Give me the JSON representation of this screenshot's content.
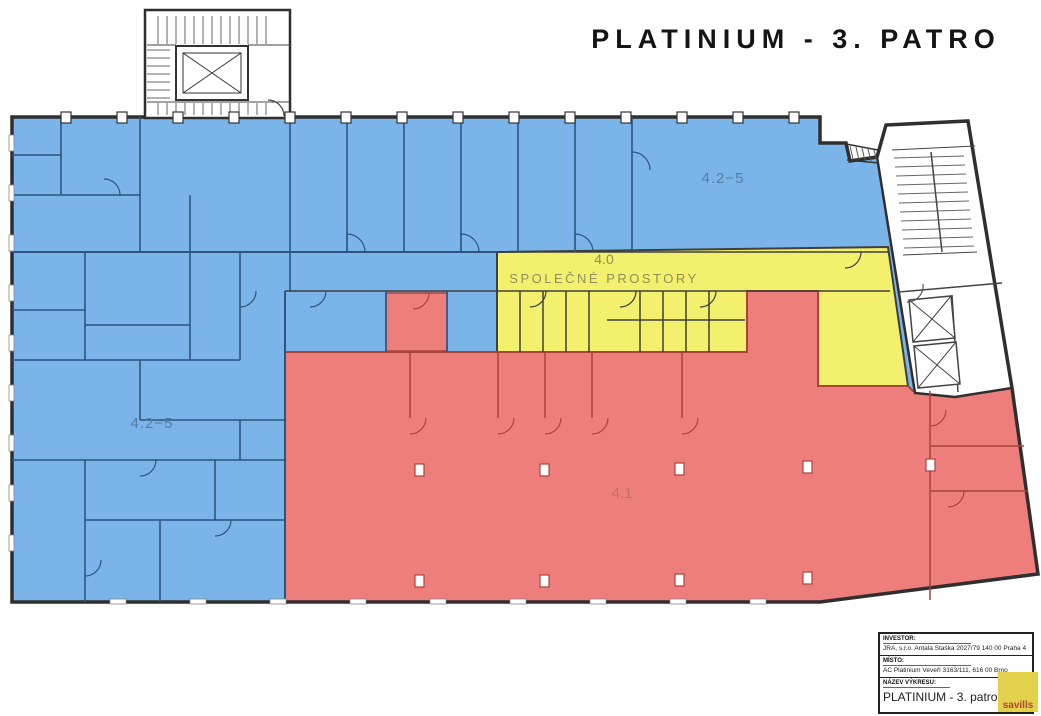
{
  "page": {
    "title": "PLATINIUM - 3. PATRO"
  },
  "plan": {
    "zones": {
      "office_left": {
        "label": "4.2−5"
      },
      "office_right": {
        "label": "4.2−5"
      },
      "common": {
        "code": "4.0",
        "label": "SPOLEČNÉ PROSTORY"
      },
      "unit_41": {
        "label": "4.1"
      }
    },
    "colors": {
      "office_blue": "#7ab4e8",
      "common_yellow": "#f3f06e",
      "unit_red": "#ee7e7c",
      "stairwell_white": "#ffffff",
      "wall_dark": "#2f2f2f",
      "wall_blue": "#2d5580",
      "wall_red": "#a94438",
      "label_blue": "#567ea6",
      "label_olive": "#8f8f5a",
      "label_red": "#c4706a",
      "logo_yellow": "#e2d14b",
      "logo_red": "#b5432f"
    }
  },
  "title_block": {
    "fields": [
      {
        "label": "INVESTOR:",
        "value": "JRA, s.r.o. Antala Staška 2027/79 140 00 Praha 4"
      },
      {
        "label": "MÍSTO:",
        "value": "AC Platinium Veveří 3163/111, 616 00 Brno"
      },
      {
        "label": "NÁZEV VÝKRESU:",
        "value": "PLATINIUM - 3. patro"
      }
    ],
    "logo_text": "savills"
  }
}
